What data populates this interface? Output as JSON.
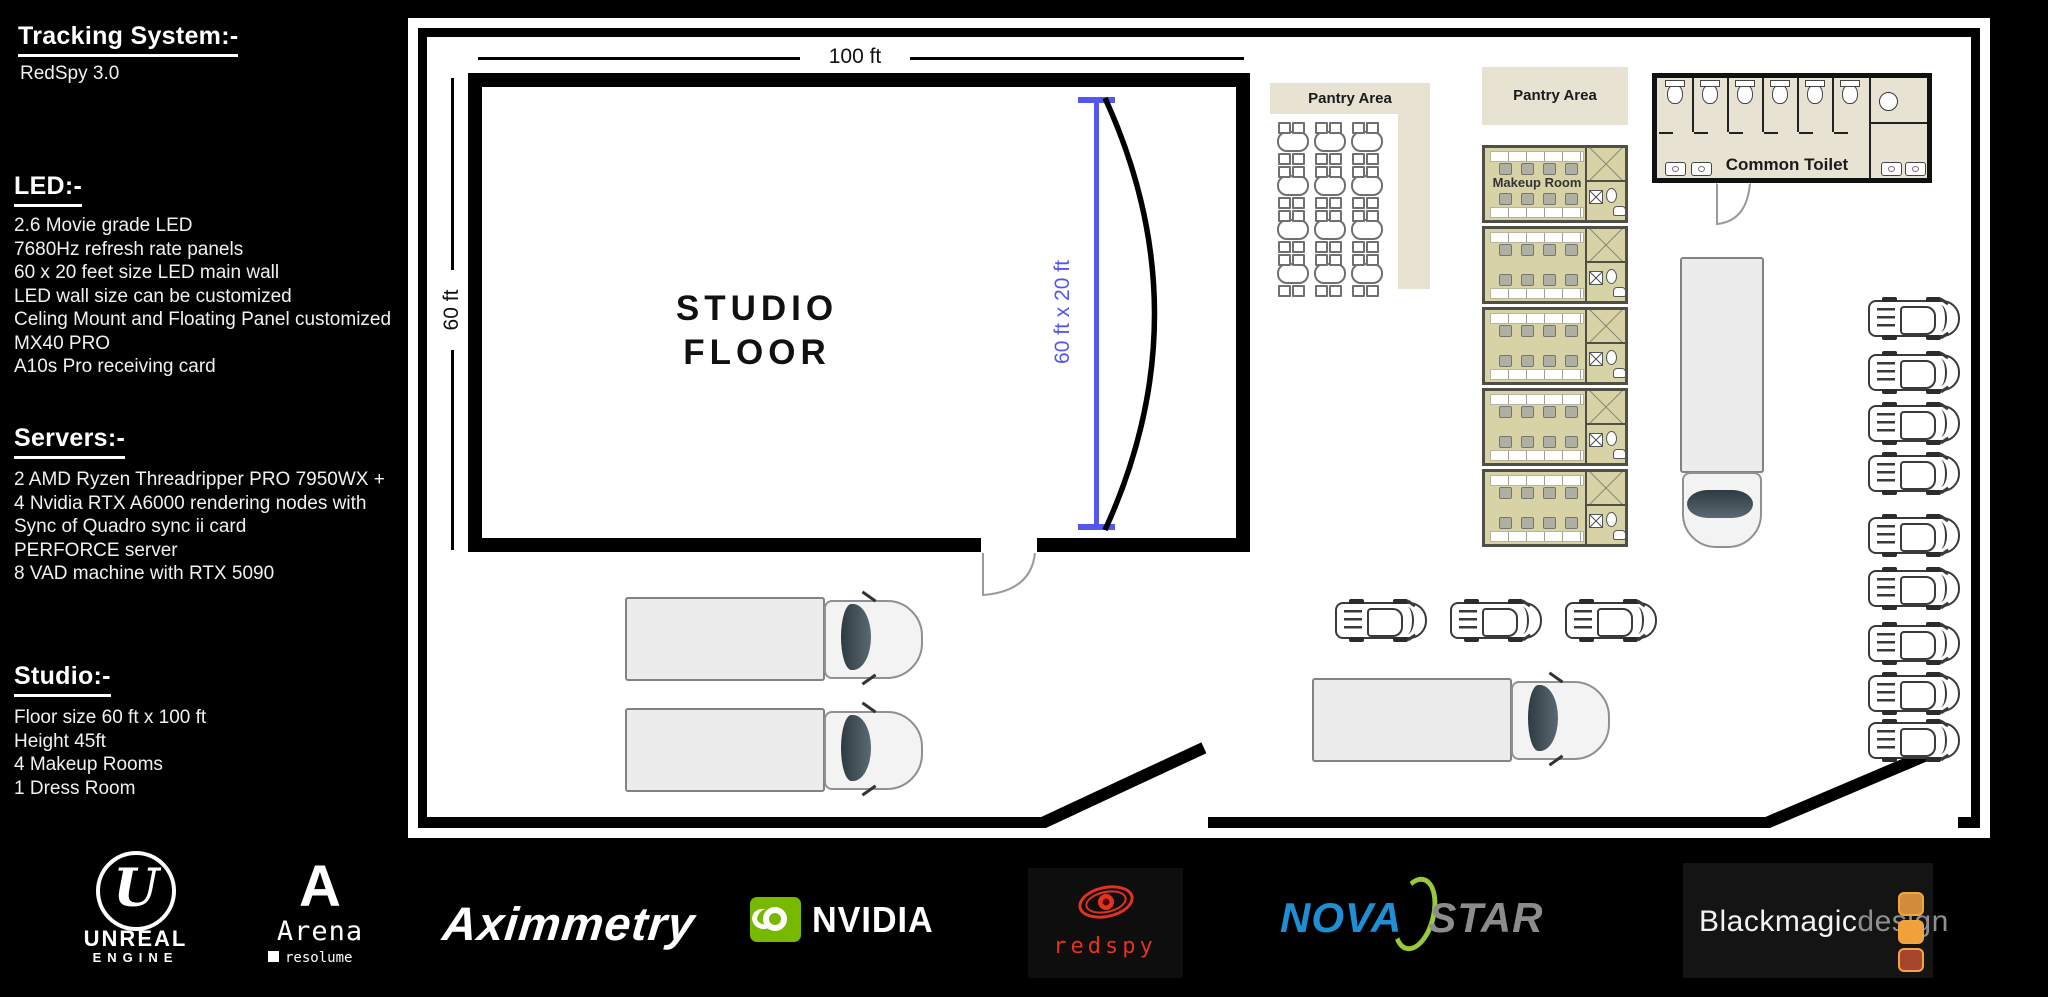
{
  "sidebar": {
    "tracking": {
      "title": "Tracking System:-",
      "lines": [
        "RedSpy 3.0"
      ]
    },
    "led": {
      "title": "LED:-",
      "lines": [
        "2.6 Movie grade LED",
        "7680Hz refresh rate panels",
        "60 x 20 feet size LED main wall",
        "LED wall size can be customized",
        "Celing Mount and Floating Panel customized",
        "MX40 PRO",
        "A10s Pro receiving card"
      ]
    },
    "servers": {
      "title": "Servers:-",
      "lines": [
        "2 AMD Ryzen Threadripper PRO 7950WX +",
        "4 Nvidia RTX A6000 rendering nodes with",
        "Sync of Quadro sync ii card",
        "PERFORCE server",
        "8 VAD machine with RTX 5090"
      ]
    },
    "studio": {
      "title": "Studio:-",
      "lines": [
        "Floor size 60 ft x 100 ft",
        "Height 45ft",
        "4 Makeup Rooms",
        "1 Dress Room"
      ]
    }
  },
  "plan": {
    "studio_floor_line1": "STUDIO",
    "studio_floor_line2": "FLOOR",
    "top_dimension": "100 ft",
    "left_dimension": "60 ft",
    "led_wall_dimension": "60 ft x 20 ft",
    "pantry_left_label": "Pantry Area",
    "pantry_right_label": "Pantry Area",
    "makeup_room_label": "Makeup Room",
    "common_toilet_label": "Common Toilet",
    "counts": {
      "pantry_table_rows": 4,
      "pantry_table_cols": 3,
      "makeup_modules": 5,
      "toilet_stalls": 6,
      "right_parked_cars": 9,
      "middle_parked_cars": 3,
      "bottom_left_trucks": 2
    }
  },
  "logos": {
    "unreal": {
      "monogram": "U",
      "name": "UNREAL",
      "sub": "ENGINE"
    },
    "arena": {
      "letter": "A",
      "name": "Arena",
      "sub": "resolume"
    },
    "aximmetry": {
      "name": "Aximmetry"
    },
    "nvidia": {
      "name": "NVIDIA"
    },
    "redspy": {
      "name": "redspy"
    },
    "novastar": {
      "part1": "NOVA",
      "part2": "STAR"
    },
    "blackmagic": {
      "part1": "Blackmagic",
      "part2": "design"
    }
  },
  "colors": {
    "dimension_blue": "#5457ee",
    "beige": "#e8e2d2",
    "room_khaki": "#d8d3a6",
    "nvidia_green": "#76b900",
    "redspy_red": "#e5321f",
    "novastar_blue": "#1e8fd5",
    "novastar_gray": "#8c8c8c",
    "novastar_swoosh": "#97c93d",
    "bmd_square_top": "#d28c3c",
    "bmd_square_mid": "#f0a13c",
    "bmd_square_bottom": "#a8452f"
  }
}
